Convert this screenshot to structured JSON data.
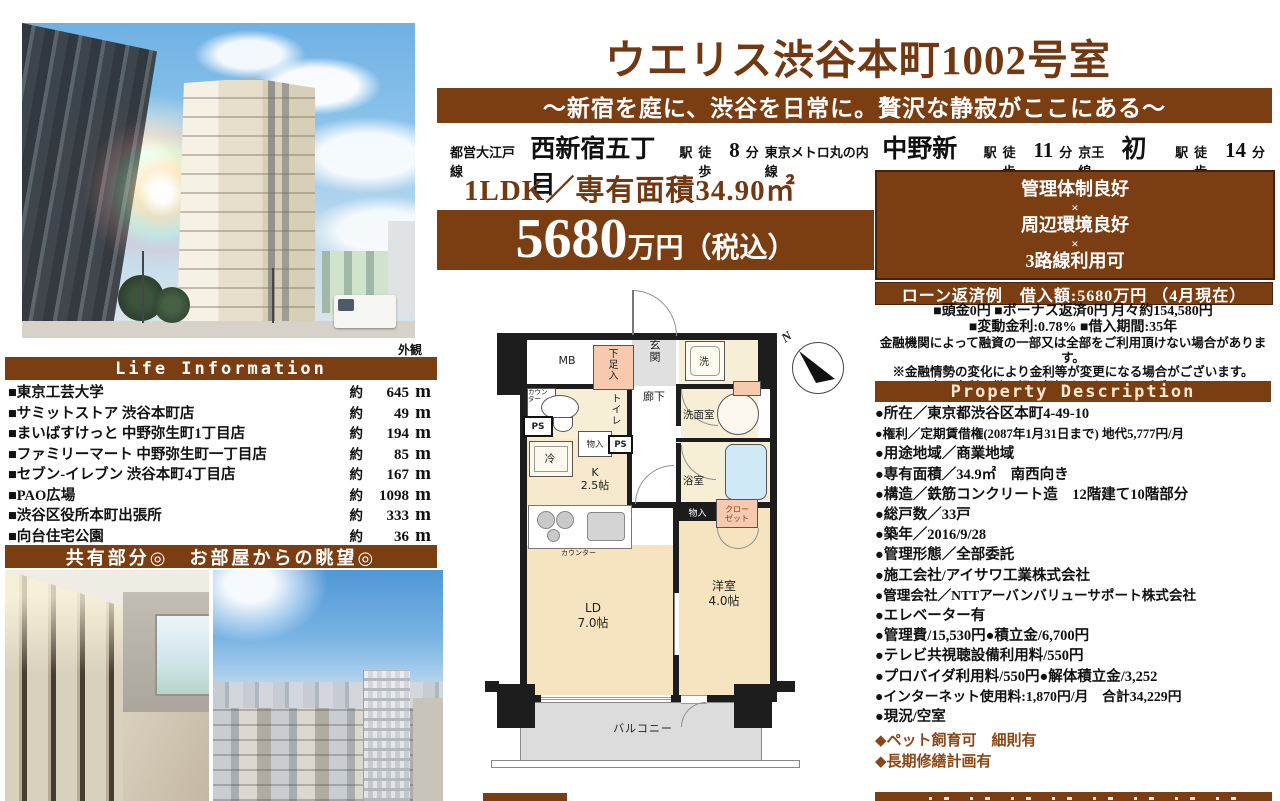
{
  "header": {
    "title": "ウエリス渋谷本町1002号室",
    "subtitle": "～新宿を庭に、渋谷を日常に。贅沢な静寂がここにある～",
    "stations": [
      {
        "line": "都営大江戸線",
        "name": "西新宿五丁目",
        "st": "駅",
        "walk": "徒歩",
        "min": "8",
        "fun": "分"
      },
      {
        "line": "東京メトロ丸の内線",
        "name": "中野新橋",
        "st": "駅",
        "walk": "徒歩",
        "min": "11",
        "fun": "分"
      },
      {
        "line": "京王線",
        "name": "初台",
        "st": "駅",
        "walk": "徒歩",
        "min": "14",
        "fun": "分"
      }
    ],
    "type_area": "1LDK／専有面積34.90㎡",
    "price_value": "5680",
    "price_unit": "万円（税込）"
  },
  "highlight": {
    "l1": "管理体制良好",
    "x1": "×",
    "l2": "周辺環境良好",
    "x2": "×",
    "l3": "3路線利用可"
  },
  "loan": {
    "header": "ローン返済例　借入額:5680万円 （4月現在）",
    "lines": [
      "■頭金0円 ■ボーナス返済0円 月々約154,580円",
      "■変動金利:0.78% ■借入期間:35年",
      "金融機関によって融資の一部又は全部をご利用頂けない場合があります。",
      "※金融情勢の変化により金利等が変更になる場合がございます。",
      "※表示金利、借入額を保証するものではございません。"
    ]
  },
  "property": {
    "header": "Property Description",
    "items": [
      "●所在／東京都渋谷区本町4-49-10",
      "●権利／定期賃借権(2087年1月31日まで) 地代5,777円/月",
      "●用途地域／商業地域",
      "●専有面積／34.9㎡　南西向き",
      "●構造／鉄筋コンクリート造　12階建て10階部分",
      "●総戸数／33戸",
      "●築年／2016/9/28",
      "●管理形態／全部委託",
      "●施工会社/アイサワ工業株式会社",
      "●管理会社／NTTアーバンバリューサポート株式会社",
      "●エレベーター有",
      "●管理費/15,530円●積立金/6,700円",
      "●テレビ共視聴設備利用料/550円",
      "●プロバイダ利用料/550円●解体積立金/3,252",
      "●インターネット使用料:1,870円/月　合計34,229円",
      "●現況/空室"
    ],
    "notes": [
      "◆ペット飼育可　細則有",
      "◆長期修繕計画有"
    ]
  },
  "life": {
    "photo_caption": "外観",
    "header": "Life Information",
    "rows": [
      {
        "name": "■東京工芸大学",
        "approx": "約",
        "dist": "645",
        "unit": "m"
      },
      {
        "name": "■サミットストア 渋谷本町店",
        "approx": "約",
        "dist": "49",
        "unit": "m"
      },
      {
        "name": "■まいばすけっと 中野弥生町1丁目店",
        "approx": "約",
        "dist": "194",
        "unit": "m"
      },
      {
        "name": "■ファミリーマート 中野弥生町一丁目店",
        "approx": "約",
        "dist": "85",
        "unit": "m"
      },
      {
        "name": "■セブン-イレブン 渋谷本町4丁目店",
        "approx": "約",
        "dist": "167",
        "unit": "m"
      },
      {
        "name": "■PAO広場",
        "approx": "約",
        "dist": "1098",
        "unit": "m"
      },
      {
        "name": "■渋谷区役所本町出張所",
        "approx": "約",
        "dist": "333",
        "unit": "m"
      },
      {
        "name": "■向台住宅公園",
        "approx": "約",
        "dist": "36",
        "unit": "m"
      }
    ],
    "photos_header": "共有部分◎　お部屋からの眺望◎"
  },
  "floorplan": {
    "mb": "MB",
    "shoe_box": "下足入",
    "entrance": "玄関",
    "washer": "洗",
    "hallway": "廊下",
    "toilet": "トイレ",
    "counter_small": "カウンター",
    "ps1": "PS",
    "ps2": "PS",
    "storage_top": "物入",
    "powder_room": "洗面室",
    "fridge": "冷",
    "kitchen": "K",
    "kitchen_size": "2.5帖",
    "counter_kitchen": "カウンター",
    "bath": "浴室",
    "storage_mid": "物入",
    "closet_l1": "クロー",
    "closet_l2": "ゼット",
    "ld": "LD",
    "ld_size": "7.0帖",
    "bedroom": "洋室",
    "bedroom_size": "4.0帖",
    "balcony": "バルコニー",
    "compass_n": "N"
  },
  "colors": {
    "accent": "#7b3e12",
    "title_brown": "#713812",
    "note_brown": "#8a4715"
  }
}
